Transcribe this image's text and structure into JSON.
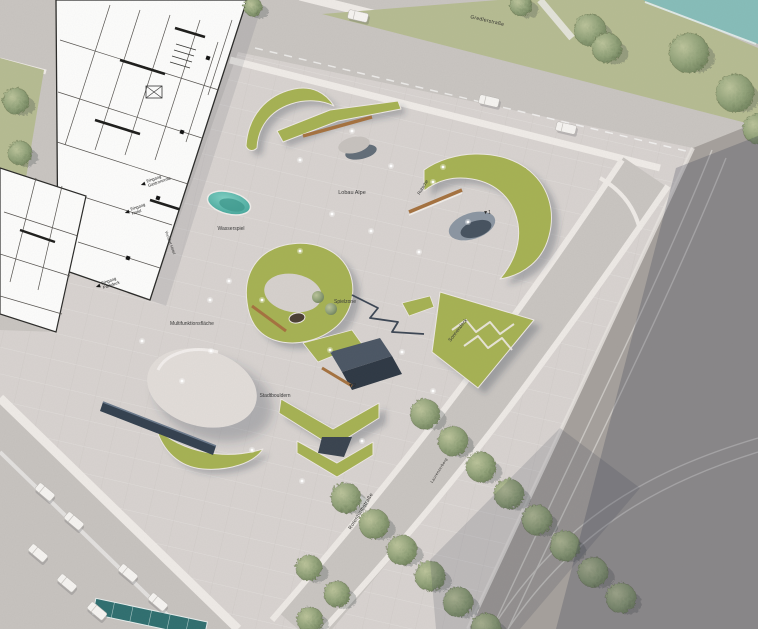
{
  "title_hint": "architectural masterplan of an urban plaza with landforms, skate/play elements, streets and tram tracks",
  "street_labels": {
    "top": "Gredlerstraße",
    "bottom": "Rotenturmstraße",
    "side": "Laurenzerberg"
  },
  "plaza_labels": [
    {
      "text": "Lobau Alpe",
      "x": 352,
      "y": 194,
      "rot": 0,
      "size": 5.5
    },
    {
      "text": "Rutsche",
      "x": 424,
      "y": 188,
      "rot": -58,
      "size": 4.5
    },
    {
      "text": "Wasserspiel",
      "x": 231,
      "y": 230,
      "rot": 0,
      "size": 5
    },
    {
      "text": "Spielzone",
      "x": 345,
      "y": 303,
      "rot": 0,
      "size": 5
    },
    {
      "text": "Stadtbouldern",
      "x": 275,
      "y": 397,
      "rot": 0,
      "size": 5
    },
    {
      "text": "Sonnendeck",
      "x": 459,
      "y": 331,
      "rot": -52,
      "size": 5
    },
    {
      "text": "Multifunktionsfläche",
      "x": 192,
      "y": 325,
      "rot": 0,
      "size": 5
    },
    {
      "text": "Vorfahrt Hotel",
      "x": 169,
      "y": 243,
      "rot": 70,
      "size": 4
    }
  ],
  "entrance_labels": [
    {
      "lines": [
        "Eingang",
        "Gastronomie"
      ],
      "x": 146,
      "y": 183,
      "rot": -19
    },
    {
      "lines": [
        "Eingang",
        "Hotel"
      ],
      "x": 130,
      "y": 211,
      "rot": -19
    },
    {
      "lines": [
        "Eingang",
        "Parkdeck"
      ],
      "x": 101,
      "y": 285,
      "rot": -19
    }
  ],
  "markers": [
    {
      "text": "▼2",
      "x": 352,
      "y": 387
    },
    {
      "text": "▼1",
      "x": 487,
      "y": 214
    }
  ],
  "colors": {
    "plaza": "#d8d3d0",
    "street": "#c9c5c1",
    "sidewalk": "#efebe7",
    "asphalt": "#a5a09c",
    "green": "#a6b253",
    "green_strip": "#b6bc92",
    "water": "#86bdb9",
    "pond": "#55b3a6",
    "wood": "#a5723f",
    "navy": "#35404e",
    "canopy": "#2f6f70",
    "shadow": "rgba(52,56,74,0.28)"
  },
  "scene": {
    "trees": [
      [
        520,
        4,
        11
      ],
      [
        252,
        6,
        9
      ],
      [
        589,
        29,
        16
      ],
      [
        606,
        47,
        15
      ],
      [
        688,
        52,
        20
      ],
      [
        734,
        92,
        19
      ],
      [
        757,
        128,
        15
      ],
      [
        15,
        100,
        13
      ],
      [
        19,
        152,
        12
      ],
      [
        424,
        413,
        15
      ],
      [
        452,
        440,
        15
      ],
      [
        480,
        466,
        15
      ],
      [
        508,
        493,
        15
      ],
      [
        536,
        519,
        15
      ],
      [
        564,
        545,
        15
      ],
      [
        592,
        571,
        15
      ],
      [
        620,
        597,
        15
      ],
      [
        345,
        497,
        15
      ],
      [
        373,
        523,
        15
      ],
      [
        401,
        549,
        15
      ],
      [
        429,
        575,
        15
      ],
      [
        457,
        601,
        15
      ],
      [
        485,
        627,
        15
      ],
      [
        308,
        567,
        13
      ],
      [
        336,
        593,
        13
      ],
      [
        309,
        619,
        13
      ]
    ],
    "cars": [
      [
        358,
        16,
        13
      ],
      [
        489,
        101,
        13
      ],
      [
        566,
        128,
        13
      ],
      [
        45,
        492,
        40
      ],
      [
        74,
        521,
        40
      ],
      [
        38,
        553,
        40
      ],
      [
        67,
        583,
        40
      ],
      [
        128,
        573,
        40
      ],
      [
        97,
        611,
        40
      ],
      [
        158,
        602,
        40
      ]
    ],
    "lights": [
      [
        300,
        160
      ],
      [
        332,
        214
      ],
      [
        371,
        231
      ],
      [
        300,
        251
      ],
      [
        262,
        300
      ],
      [
        229,
        281
      ],
      [
        211,
        351
      ],
      [
        252,
        450
      ],
      [
        302,
        481
      ],
      [
        362,
        441
      ],
      [
        402,
        352
      ],
      [
        419,
        252
      ],
      [
        468,
        222
      ],
      [
        352,
        131
      ],
      [
        391,
        166
      ],
      [
        433,
        391
      ],
      [
        182,
        381
      ],
      [
        142,
        341
      ],
      [
        443,
        167
      ],
      [
        433,
        182
      ],
      [
        330,
        350
      ],
      [
        210,
        300
      ]
    ]
  }
}
